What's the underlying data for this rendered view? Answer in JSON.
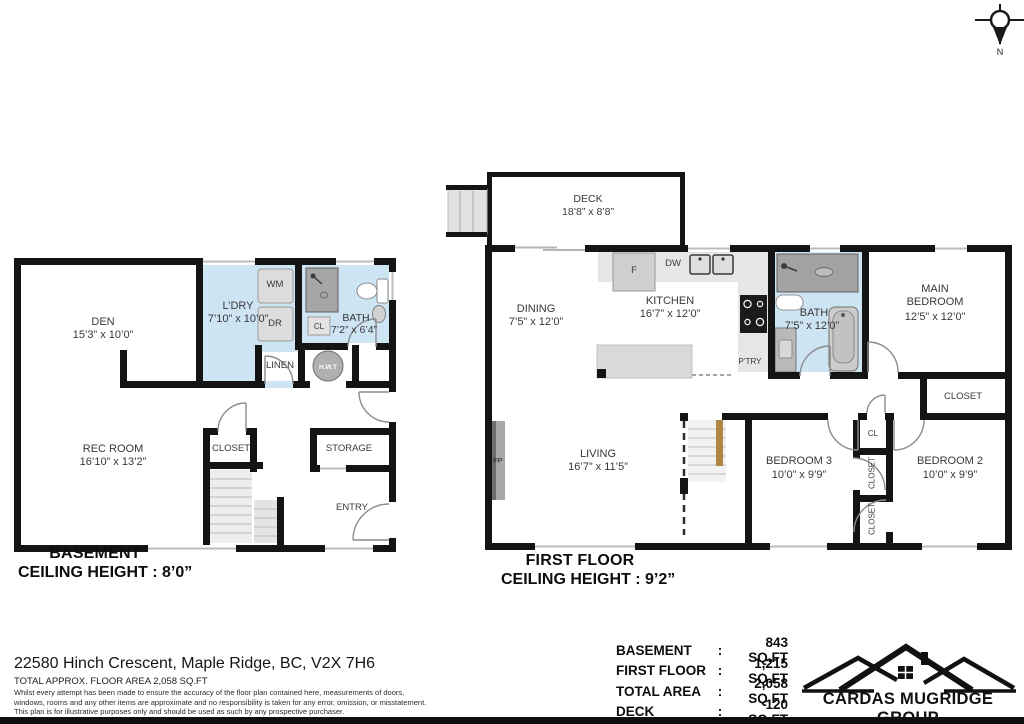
{
  "compass": {
    "north_label": "N"
  },
  "basement": {
    "title": "BASEMENT",
    "ceiling": "CEILING HEIGHT : 8’0”",
    "rooms": {
      "den": {
        "name": "DEN",
        "dims": "15’3” x 10’0”"
      },
      "laundry": {
        "name": "L’DRY",
        "dims": "7’10” x 10’0”"
      },
      "bath": {
        "name": "BATH",
        "dims": "7’2” x 6’4”"
      },
      "rec_room": {
        "name": "REC ROOM",
        "dims": "16’10” x 13’2”"
      },
      "closet": {
        "name": "CLOSET"
      },
      "storage": {
        "name": "STORAGE"
      },
      "entry": {
        "name": "ENTRY"
      },
      "linen": {
        "name": "LINEN"
      }
    },
    "fixtures": {
      "washer": "WM",
      "dryer": "DR",
      "closet_small": "CL",
      "water_tank": "H.W.T"
    }
  },
  "first_floor": {
    "title": "FIRST FLOOR",
    "ceiling": "CEILING HEIGHT : 9’2”",
    "rooms": {
      "deck": {
        "name": "DECK",
        "dims": "18’8” x 8’8”"
      },
      "dining": {
        "name": "DINING",
        "dims": "7’5” x 12’0”"
      },
      "kitchen": {
        "name": "KITCHEN",
        "dims": "16’7” x 12’0”"
      },
      "bath": {
        "name": "BATH",
        "dims": "7’5” x 12’0”"
      },
      "main_bedroom": {
        "name_line1": "MAIN",
        "name_line2": "BEDROOM",
        "dims": "12’5” x 12’0”"
      },
      "living": {
        "name": "LIVING",
        "dims": "16’7” x 11’5”"
      },
      "bedroom3": {
        "name": "BEDROOM 3",
        "dims": "10’0” x 9’9”"
      },
      "bedroom2": {
        "name": "BEDROOM 2",
        "dims": "10’0” x 9’9”"
      },
      "closet_main": {
        "name": "CLOSET"
      },
      "closet_cl": {
        "name": "CL"
      },
      "closet_v1": {
        "name": "CLOSET"
      },
      "closet_v2": {
        "name": "CLOSET"
      }
    },
    "fixtures": {
      "fridge": "F",
      "dishwasher": "DW",
      "pantry": "P’TRY",
      "fireplace": "FP"
    }
  },
  "footer": {
    "address": "22580 Hinch Crescent, Maple Ridge, BC, V2X 7H6",
    "total_line": "TOTAL APPROX. FLOOR AREA 2,058 SQ.FT",
    "disclaimer_1": "Whilst every attempt has been made to ensure the accuracy of the floor plan contained here, measurements of doors,",
    "disclaimer_2": "windows, rooms and any other items are approximate and no responsibility is taken for any error, omission, or misstatement.",
    "disclaimer_3": "This plan is for illustrative purposes only and should be used as such by any prospective purchaser.",
    "areas": [
      {
        "label": "BASEMENT",
        "sep": ":",
        "value": "843 SQ.FT"
      },
      {
        "label": "FIRST FLOOR",
        "sep": ":",
        "value": "1,215 SQ.FT"
      },
      {
        "label": "TOTAL AREA",
        "sep": ":",
        "value": "2,058 SQ.FT"
      },
      {
        "label": "DECK",
        "sep": ":",
        "value": "120 SQ.FT"
      }
    ],
    "logo_text": "CARDAS MUGRIDGE GROUP"
  }
}
